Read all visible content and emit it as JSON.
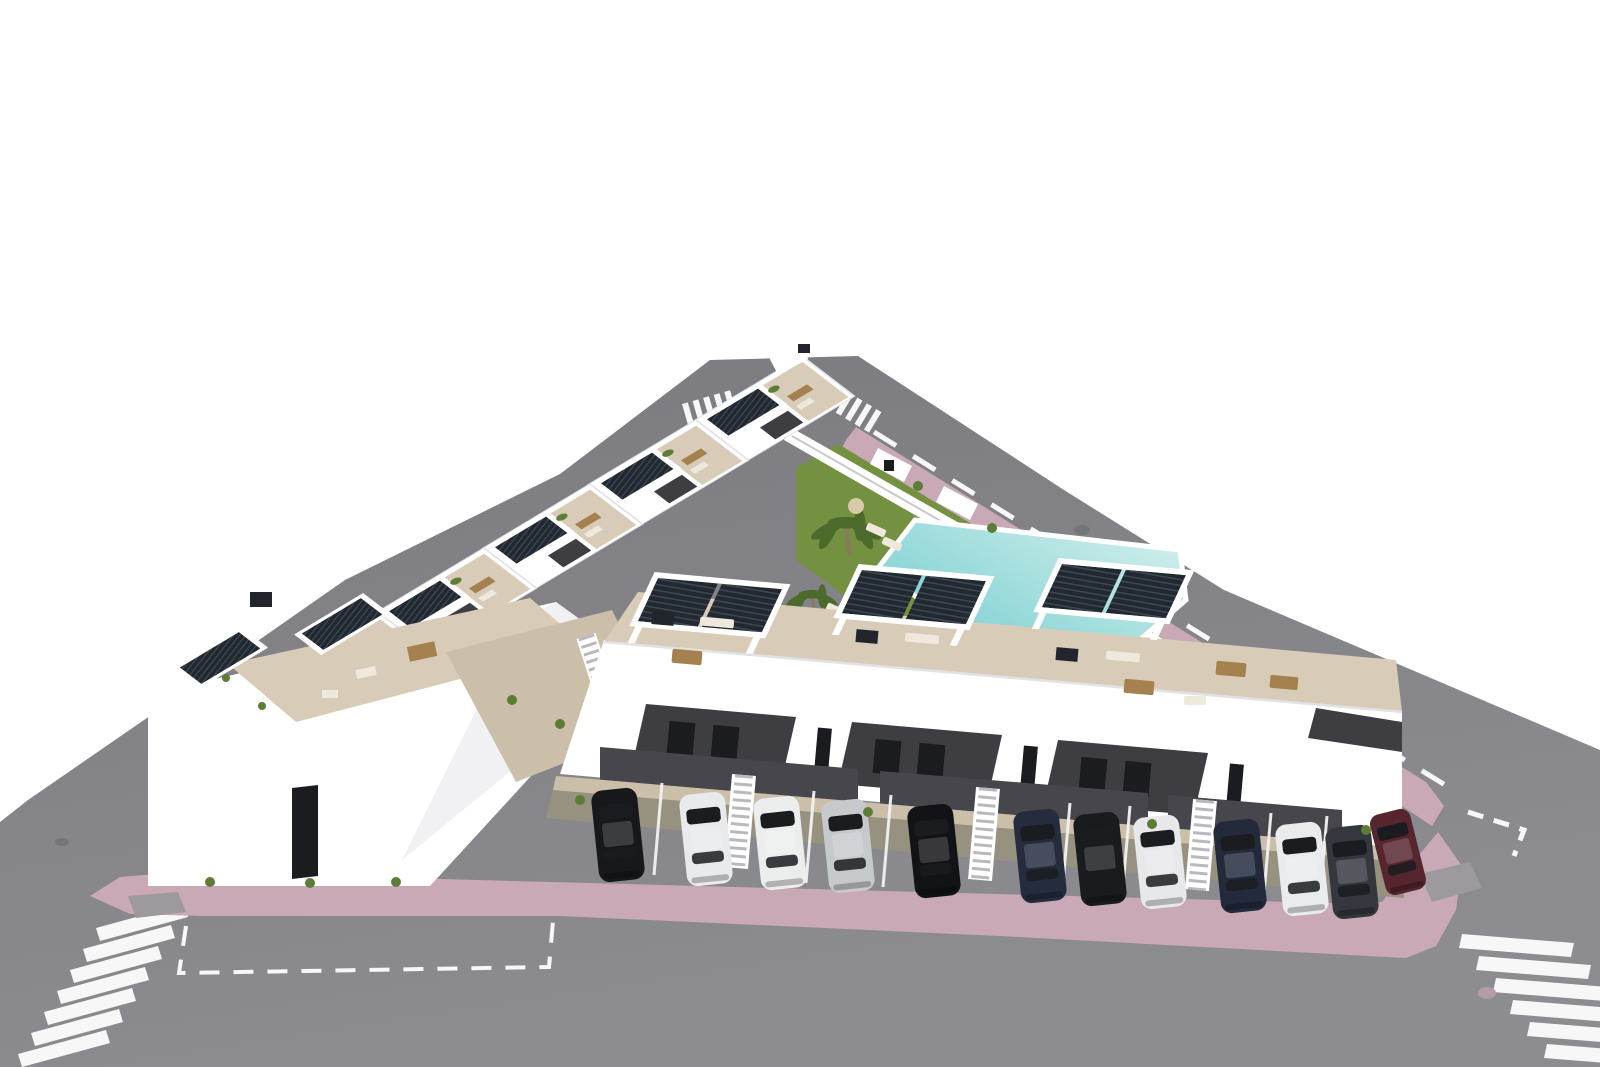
{
  "meta": {
    "description": "Aerial 3D architectural rendering of a modern white residential complex on a triangular plot: rooftop terraces with dark slatted solar pergolas, communal lawn with swimming pool and palm trees, perimeter streets with zebra crossings and pink paved sidewalks, and a front parking row with cars.",
    "style": "photorealistic CGI aerial view"
  },
  "colors": {
    "bg": "#ffffff",
    "road_top": "#7b7b7f",
    "road_bottom": "#8d8d91",
    "marking": "#f7f7f7",
    "sidewalk_pink": "#c9a9b5",
    "tactile_gray": "#9d999d",
    "lawn": "#739140",
    "palm": "#4c6a2b",
    "shrub": "#5d7c35",
    "trunk": "#8a7a5c",
    "pool_light": "#d9f1ee",
    "pool_deep": "#5fc6c9",
    "pool_deck": "#efece3",
    "terrace_beige": "#d8ccb8",
    "path_beige": "#cbbfa9",
    "stall_floor": "#97917f",
    "white": "#ffffff",
    "white_shade": "#f1f1f3",
    "parapet_line": "#e2e2e6",
    "dark_panel": "#3d3d42",
    "carport_shadow": "#46464c",
    "glass": "#1a1c20",
    "slat_dark": "#212830",
    "slat_light": "#3d4753",
    "wood": "#a5814f",
    "cushion": "#efe9dd",
    "stair_tread": "#b9b9bd",
    "chimney": "#22262c",
    "umbrella_tan": "#d8c9a8",
    "manhole_road": "#76767a",
    "manhole_pink": "#b39ca6",
    "divider": "#f2f2f2"
  },
  "scene": {
    "ground": "asphalt streets around triangular block",
    "sidewalk": "pink paved sidewalk band",
    "lawn": "communal garden lawn",
    "pool": "communal swimming pool",
    "back_row_houses": 6,
    "front_row_pergola_pairs": 3,
    "palms": 2,
    "crosswalks": 4,
    "cars": [
      {
        "name": "car-1",
        "color": "#17181c"
      },
      {
        "name": "car-2",
        "color": "#e9eaec"
      },
      {
        "name": "car-3",
        "color": "#eceded"
      },
      {
        "name": "car-4",
        "color": "#c7cacd"
      },
      {
        "name": "car-5",
        "color": "#121317"
      },
      {
        "name": "car-6",
        "color": "#242c3e"
      },
      {
        "name": "car-7",
        "color": "#1a1b1f"
      },
      {
        "name": "car-8",
        "color": "#e7e8ea"
      },
      {
        "name": "car-9",
        "color": "#222a3c"
      },
      {
        "name": "car-10",
        "color": "#eaebed"
      },
      {
        "name": "car-11",
        "color": "#34373d"
      },
      {
        "name": "car-12",
        "color": "#56252e"
      }
    ]
  }
}
